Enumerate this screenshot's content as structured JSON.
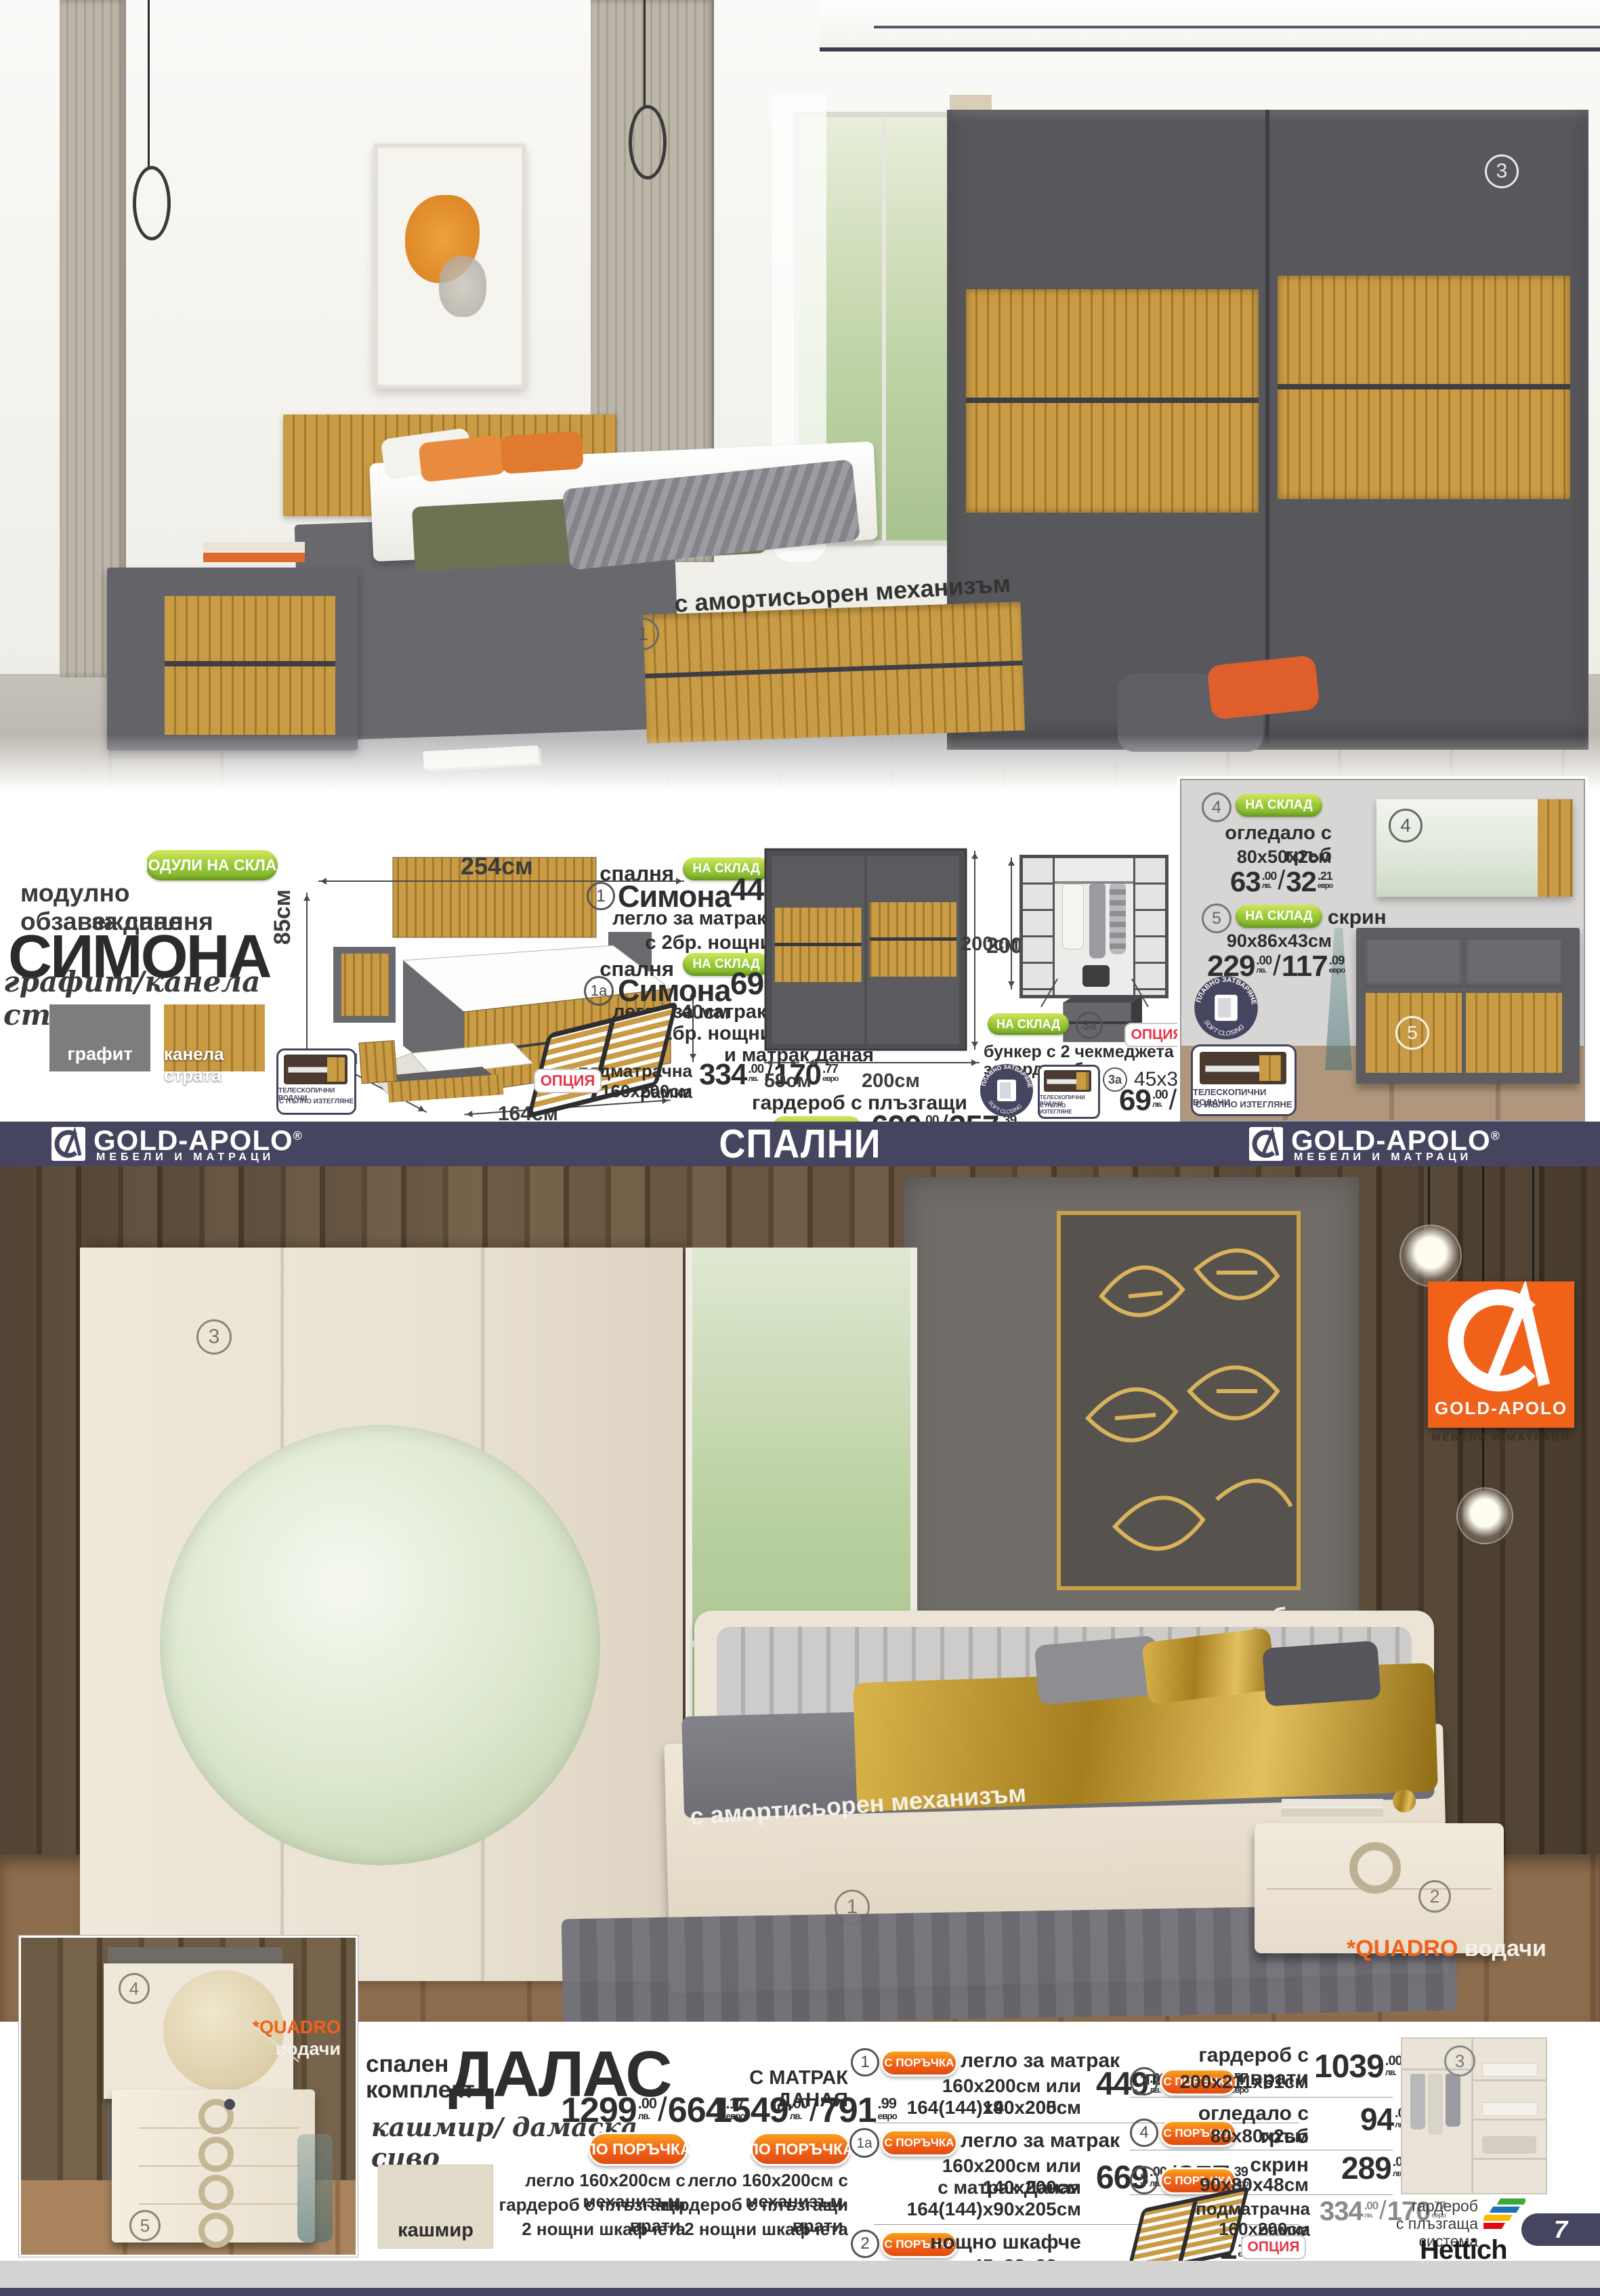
{
  "colors": {
    "navy": "#45455f",
    "green": "#8cc63e",
    "orange": "#f0611a",
    "red": "#e8334a",
    "wood": "#c99b45",
    "graphite": "#777777",
    "cream": "#e9e1d2"
  },
  "currency": {
    "lv": "лв.",
    "eur": "евро"
  },
  "brand": {
    "name": "GOLD-APOLO",
    "reg": "®",
    "sub": "МЕБЕЛИ И МАТРАЦИ"
  },
  "band": {
    "title": "СПАЛНИ"
  },
  "page": {
    "number": "7"
  },
  "badges": {
    "in_stock": "НА СКЛАД",
    "on_order": "С ПОРЪЧКА",
    "on_order_big": "ПО ПОРЪЧКА",
    "option": "ОПЦИЯ",
    "modules_in_stock": "МОДУЛИ НА СКЛАД",
    "telescopic_1": "ТЕЛЕСКОПИЧНИ ВОДАЧИ",
    "telescopic_2": "С ПЪЛНО ИЗТЕГЛЯНЕ",
    "soft_close_bg": "ПЛАВНО ЗАТВАРЯНЕ",
    "soft_close_en": "SOFT CLOSING"
  },
  "top_hero": {
    "mechanism_note": "с амортисьорен механизъм",
    "marker_bed": "1",
    "marker_wardrobe": "3"
  },
  "simona": {
    "intro_line1": "модулно обзавеждане",
    "intro_line2": "за спалня",
    "name": "СИМОНА",
    "finish": "графит/канела страта",
    "swatch1": "графит",
    "swatch2": "канела страта",
    "dims": {
      "width": "254см",
      "height": "85см",
      "box": "40см",
      "depth": "205см",
      "inner": "164см"
    },
    "offer1": {
      "num": "1",
      "type": "спалня",
      "name": "Симона",
      "lv_main": "449",
      "lv_dec": ".00",
      "eur_main": "229",
      "eur_dec": ".57",
      "line1": "легло за матрак  160х200см",
      "line2": "с 2бр. нощни шкафчета"
    },
    "offer1a": {
      "num": "1а",
      "type": "спалня",
      "name": "Симона",
      "lv_main": "699",
      "lv_dec": ".00",
      "eur_main": "357",
      "eur_dec": ".39",
      "line1": "легло за матрак 160х200см",
      "line2": "с 2бр. нощни шкафчета",
      "line3": "и матрак Даная"
    },
    "frame": {
      "name1": "подматрачна рамка",
      "name2": "160х200см",
      "lv_main": "334",
      "lv_dec": ".00",
      "eur_main": "170",
      "eur_dec": ".77"
    },
    "wardrobe": {
      "h": "200см",
      "d": "59см",
      "w": "200см",
      "name": "гардероб с плъзгащи врати",
      "lv_main": "699",
      "lv_dec": ".00",
      "eur_main": "357",
      "eur_dec": ".39"
    },
    "interior_h": "200см",
    "bunker": {
      "title": "бункер с 2 чекмеджета за гардероб",
      "num": "3а",
      "size": "45х35х50см",
      "lv_main": "69",
      "lv_dec": ".00",
      "eur_main": "35",
      "eur_dec": ".28"
    },
    "mirror": {
      "num": "4",
      "name": "огледало с гръб",
      "size": "80х50х2см",
      "lv_main": "63",
      "lv_dec": ".00",
      "eur_main": "32",
      "eur_dec": ".21"
    },
    "dresser": {
      "num": "5",
      "name": "скрин",
      "size": "90х86х43см",
      "lv_main": "229",
      "lv_dec": ".00",
      "eur_main": "117",
      "eur_dec": ".09"
    }
  },
  "bottom_hero": {
    "headboard_note": "тапицирана табла",
    "mechanism_note": "с амортисьорен механизъм",
    "quadro_star": "*QUADRO",
    "quadro_word": "водачи",
    "markers": {
      "bed": "1",
      "nightstand": "2",
      "wardrobe": "3",
      "mirror": "4",
      "dresser": "5"
    }
  },
  "dalas": {
    "pre1": "спален",
    "pre2": "комплект",
    "name": "ДАЛАС",
    "finish": "кашмир/ дамаска сиво",
    "swatch": "кашмир",
    "combo1": {
      "lv_main": "1299",
      "lv_dec": ".00",
      "eur_main": "664",
      "eur_dec": ".17",
      "line1": "легло 160х200см с механизъм,",
      "line2": "гардероб с плъзгащи врати,",
      "line3": "2 нощни шкафчета"
    },
    "combo2": {
      "title": "С МАТРАК ДАНАЯ",
      "lv_main": "1549",
      "lv_dec": ".00",
      "eur_main": "791",
      "eur_dec": ".99",
      "line1": "легло 160х200см с механизъм,",
      "line2": "гардероб с плъзгащи врати,",
      "line3": "2 нощни шкафчета"
    },
    "list_left": [
      {
        "num": "1",
        "name": "легло за матрак",
        "l2": "160х200см или 140х200см",
        "l3": "164(144)х90х205см",
        "lv_main": "449",
        "lv_dec": ".00",
        "eur_main": "229",
        "eur_dec": ".57"
      },
      {
        "num": "1а",
        "name": "легло за матрак",
        "l2": "160х200см или 140х200см",
        "l3": "с матрак Даная",
        "l4": "164(144)х90х205см",
        "lv_main": "669",
        "lv_dec": ".00",
        "eur_main": "357",
        "eur_dec": ".39"
      },
      {
        "num": "2",
        "name": "нощно шкафче",
        "l2": "45х28х38см",
        "lv_main": "62",
        "lv_dec": ".00",
        "eur_main": "31",
        "eur_dec": ".70"
      }
    ],
    "list_right": [
      {
        "num": "3",
        "name": "гардероб с плъзгащи врати",
        "size": "200х211х61см",
        "lv_main": "1039",
        "lv_dec": ".00",
        "eur_main": "531",
        "eur_dec": ".23"
      },
      {
        "num": "4",
        "name": "огледало с гръб",
        "size": "80х80х2см",
        "lv_main": "94",
        "lv_dec": ".00",
        "eur_main": "48",
        "eur_dec": ".06"
      },
      {
        "num": "5",
        "name": "скрин",
        "size": "90х80х48см",
        "lv_main": "289",
        "lv_dec": ".00",
        "eur_main": "147",
        "eur_dec": ".76"
      }
    ],
    "frame_option": {
      "name1": "подматрачна рамка",
      "name2": "160х200см",
      "lv_main": "334",
      "lv_dec": ".00",
      "eur_main": "170",
      "eur_dec": ".77"
    },
    "hettich": {
      "marker": "3",
      "l1": "гардероб",
      "l2": "с плъзгаща",
      "l3": "система",
      "brand": "Hettich"
    }
  }
}
